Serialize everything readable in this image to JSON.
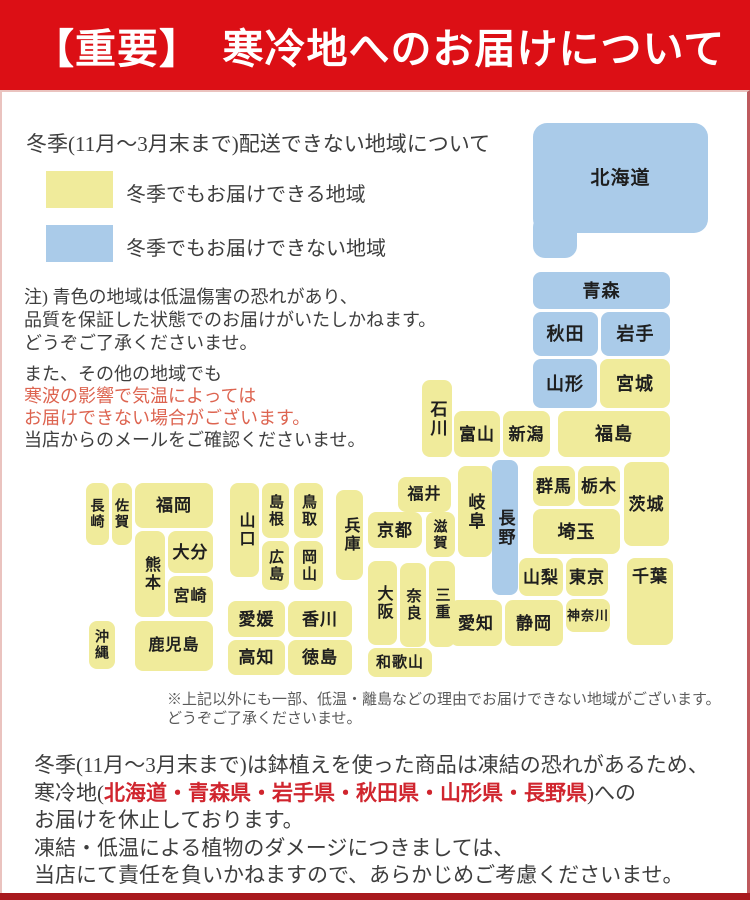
{
  "colors": {
    "banner_bg": "#dc0f15",
    "banner_text": "#ffffff",
    "deliverable_yellow": "#f0eb9b",
    "not_deliverable_blue": "#aacbe9",
    "body_text": "#3e3e3e",
    "warning_red_text": "#dd6450",
    "footer_red_bold": "#d0252e",
    "footer_bar": "#a8191e",
    "frame_border": "#eac3bf"
  },
  "header": {
    "title": "【重要】　寒冷地へのお届けについて"
  },
  "legend": {
    "intro": "冬季(11月～3月末まで)配送できない地域について",
    "deliverable_label": "冬季でもお届けできる地域",
    "not_deliverable_label": "冬季でもお届けできない地域"
  },
  "notes": {
    "block1": [
      {
        "text": "注) 青色の地域は低温傷害の恐れがあり、"
      },
      {
        "text": "品質を保証した状態でのお届けがいたしかねます。"
      },
      {
        "text": "どうぞご了承くださいませ。"
      }
    ],
    "block2": [
      {
        "text": "また、その他の地域でも"
      },
      {
        "text": "寒波の影響で気温によっては",
        "red": true
      },
      {
        "text": "お届けできない場合がございます。",
        "red": true
      },
      {
        "text": "当店からのメールをご確認くださいませ。"
      }
    ]
  },
  "footnote": {
    "lines": [
      "※上記以外にも一部、低温・離島などの理由でお届けできない地域がございます。",
      "どうぞご了承くださいませ。"
    ]
  },
  "footer": {
    "lines": [
      [
        {
          "text": "冬季(11月～3月末まで)は鉢植えを使った商品は凍結の恐れがあるため、"
        }
      ],
      [
        {
          "text": "寒冷地("
        },
        {
          "text": "北海道・青森県・岩手県・秋田県・山形県・長野県",
          "red_bold": true
        },
        {
          "text": ")への"
        }
      ],
      [
        {
          "text": "お届けを休止しております。"
        }
      ],
      [
        {
          "text": "凍結・低温による植物のダメージにつきましては、"
        }
      ],
      [
        {
          "text": "当店にて責任を負いかねますので、あらかじめご考慮くださいませ。"
        }
      ]
    ]
  },
  "map": {
    "extra_shapes": [
      {
        "key": "hokkaido-tab",
        "x": 533,
        "y": 215,
        "w": 44,
        "h": 43,
        "color": "blue",
        "r": 12
      }
    ],
    "prefectures": [
      {
        "key": "hokkaido",
        "label": "北海道",
        "x": 533,
        "y": 123,
        "w": 175,
        "h": 110,
        "color": "blue",
        "fs": 19,
        "r": 14
      },
      {
        "key": "aomori",
        "label": "青森",
        "x": 533,
        "y": 272,
        "w": 137,
        "h": 37,
        "color": "blue",
        "fs": 18
      },
      {
        "key": "akita",
        "label": "秋田",
        "x": 533,
        "y": 312,
        "w": 65,
        "h": 44,
        "color": "blue",
        "fs": 18
      },
      {
        "key": "iwate",
        "label": "岩手",
        "x": 601,
        "y": 312,
        "w": 69,
        "h": 44,
        "color": "blue",
        "fs": 18
      },
      {
        "key": "yamagata",
        "label": "山形",
        "x": 533,
        "y": 359,
        "w": 64,
        "h": 49,
        "color": "blue",
        "fs": 18
      },
      {
        "key": "miyagi",
        "label": "宮城",
        "x": 600,
        "y": 359,
        "w": 70,
        "h": 49,
        "color": "yellow",
        "fs": 18
      },
      {
        "key": "fukushima",
        "label": "福島",
        "x": 558,
        "y": 411,
        "w": 112,
        "h": 46,
        "color": "yellow",
        "fs": 18
      },
      {
        "key": "niigata",
        "label": "新潟",
        "x": 503,
        "y": 411,
        "w": 47,
        "h": 46,
        "color": "yellow",
        "fs": 17
      },
      {
        "key": "toyama",
        "label": "富山",
        "x": 454,
        "y": 411,
        "w": 46,
        "h": 46,
        "color": "yellow",
        "fs": 17
      },
      {
        "key": "ishikawa",
        "label": "石川",
        "x": 422,
        "y": 380,
        "w": 30,
        "h": 77,
        "color": "yellow",
        "fs": 17,
        "vertical": true
      },
      {
        "key": "nagano",
        "label": "長野",
        "x": 492,
        "y": 460,
        "w": 26,
        "h": 135,
        "color": "blue",
        "fs": 17,
        "vertical": true
      },
      {
        "key": "gunma",
        "label": "群馬",
        "x": 533,
        "y": 466,
        "w": 42,
        "h": 40,
        "color": "yellow",
        "fs": 17
      },
      {
        "key": "tochigi",
        "label": "栃木",
        "x": 578,
        "y": 466,
        "w": 42,
        "h": 40,
        "color": "yellow",
        "fs": 17
      },
      {
        "key": "ibaraki",
        "label": "茨城",
        "x": 624,
        "y": 462,
        "w": 45,
        "h": 84,
        "color": "yellow",
        "fs": 17
      },
      {
        "key": "saitama",
        "label": "埼玉",
        "x": 533,
        "y": 509,
        "w": 87,
        "h": 45,
        "color": "yellow",
        "fs": 18
      },
      {
        "key": "yamanashi",
        "label": "山梨",
        "x": 519,
        "y": 558,
        "w": 44,
        "h": 38,
        "color": "yellow",
        "fs": 17
      },
      {
        "key": "tokyo",
        "label": "東京",
        "x": 566,
        "y": 558,
        "w": 42,
        "h": 38,
        "color": "yellow",
        "fs": 17
      },
      {
        "key": "chiba",
        "label": "千葉",
        "x": 627,
        "y": 558,
        "w": 46,
        "h": 87,
        "color": "yellow",
        "fs": 17,
        "valign": "top"
      },
      {
        "key": "kanagawa",
        "label": "神奈川",
        "x": 566,
        "y": 599,
        "w": 44,
        "h": 33,
        "color": "yellow",
        "fs": 13
      },
      {
        "key": "shizuoka",
        "label": "静岡",
        "x": 505,
        "y": 600,
        "w": 58,
        "h": 46,
        "color": "yellow",
        "fs": 17
      },
      {
        "key": "aichi",
        "label": "愛知",
        "x": 450,
        "y": 600,
        "w": 52,
        "h": 46,
        "color": "yellow",
        "fs": 17
      },
      {
        "key": "fukui",
        "label": "福井",
        "x": 398,
        "y": 477,
        "w": 53,
        "h": 35,
        "color": "yellow",
        "fs": 16
      },
      {
        "key": "gifu",
        "label": "岐阜",
        "x": 458,
        "y": 466,
        "w": 34,
        "h": 91,
        "color": "yellow",
        "fs": 17,
        "vertical": true
      },
      {
        "key": "shiga",
        "label": "滋賀",
        "x": 426,
        "y": 512,
        "w": 29,
        "h": 45,
        "color": "yellow",
        "fs": 14,
        "vertical": true
      },
      {
        "key": "kyoto",
        "label": "京都",
        "x": 368,
        "y": 512,
        "w": 54,
        "h": 36,
        "color": "yellow",
        "fs": 17
      },
      {
        "key": "mie",
        "label": "三重",
        "x": 429,
        "y": 561,
        "w": 26,
        "h": 86,
        "color": "yellow",
        "fs": 15,
        "vertical": true
      },
      {
        "key": "nara",
        "label": "奈良",
        "x": 400,
        "y": 563,
        "w": 26,
        "h": 84,
        "color": "yellow",
        "fs": 15,
        "vertical": true
      },
      {
        "key": "osaka",
        "label": "大阪",
        "x": 368,
        "y": 561,
        "w": 29,
        "h": 84,
        "color": "yellow",
        "fs": 16,
        "vertical": true
      },
      {
        "key": "wakayama",
        "label": "和歌山",
        "x": 368,
        "y": 648,
        "w": 64,
        "h": 29,
        "color": "yellow",
        "fs": 15
      },
      {
        "key": "hyogo",
        "label": "兵庫",
        "x": 336,
        "y": 490,
        "w": 27,
        "h": 90,
        "color": "yellow",
        "fs": 16,
        "vertical": true
      },
      {
        "key": "tottori",
        "label": "鳥取",
        "x": 294,
        "y": 483,
        "w": 29,
        "h": 55,
        "color": "yellow",
        "fs": 15,
        "vertical": true
      },
      {
        "key": "okayama",
        "label": "岡山",
        "x": 294,
        "y": 541,
        "w": 29,
        "h": 49,
        "color": "yellow",
        "fs": 15,
        "vertical": true
      },
      {
        "key": "shimane",
        "label": "島根",
        "x": 262,
        "y": 483,
        "w": 27,
        "h": 55,
        "color": "yellow",
        "fs": 15,
        "vertical": true
      },
      {
        "key": "hiroshima",
        "label": "広島",
        "x": 262,
        "y": 541,
        "w": 27,
        "h": 49,
        "color": "yellow",
        "fs": 15,
        "vertical": true
      },
      {
        "key": "yamaguchi",
        "label": "山口",
        "x": 230,
        "y": 483,
        "w": 29,
        "h": 94,
        "color": "yellow",
        "fs": 16,
        "vertical": true
      },
      {
        "key": "ehime",
        "label": "愛媛",
        "x": 228,
        "y": 601,
        "w": 57,
        "h": 36,
        "color": "yellow",
        "fs": 17
      },
      {
        "key": "kagawa",
        "label": "香川",
        "x": 288,
        "y": 601,
        "w": 64,
        "h": 36,
        "color": "yellow",
        "fs": 17
      },
      {
        "key": "kochi",
        "label": "高知",
        "x": 228,
        "y": 640,
        "w": 57,
        "h": 35,
        "color": "yellow",
        "fs": 17
      },
      {
        "key": "tokushima",
        "label": "徳島",
        "x": 288,
        "y": 640,
        "w": 64,
        "h": 35,
        "color": "yellow",
        "fs": 17
      },
      {
        "key": "nagasaki",
        "label": "長崎",
        "x": 86,
        "y": 483,
        "w": 23,
        "h": 62,
        "color": "yellow",
        "fs": 14,
        "vertical": true
      },
      {
        "key": "saga",
        "label": "佐賀",
        "x": 112,
        "y": 483,
        "w": 20,
        "h": 62,
        "color": "yellow",
        "fs": 14,
        "vertical": true
      },
      {
        "key": "fukuoka",
        "label": "福岡",
        "x": 135,
        "y": 483,
        "w": 78,
        "h": 45,
        "color": "yellow",
        "fs": 17
      },
      {
        "key": "kumamoto",
        "label": "熊本",
        "x": 135,
        "y": 531,
        "w": 30,
        "h": 86,
        "color": "yellow",
        "fs": 16,
        "vertical": true
      },
      {
        "key": "oita",
        "label": "大分",
        "x": 168,
        "y": 531,
        "w": 45,
        "h": 42,
        "color": "yellow",
        "fs": 17
      },
      {
        "key": "miyazaki",
        "label": "宮崎",
        "x": 168,
        "y": 576,
        "w": 45,
        "h": 41,
        "color": "yellow",
        "fs": 16
      },
      {
        "key": "kagoshima",
        "label": "鹿児島",
        "x": 135,
        "y": 621,
        "w": 78,
        "h": 50,
        "color": "yellow",
        "fs": 16
      },
      {
        "key": "okinawa",
        "label": "沖縄",
        "x": 89,
        "y": 621,
        "w": 26,
        "h": 48,
        "color": "yellow",
        "fs": 14,
        "vertical": true
      }
    ]
  }
}
